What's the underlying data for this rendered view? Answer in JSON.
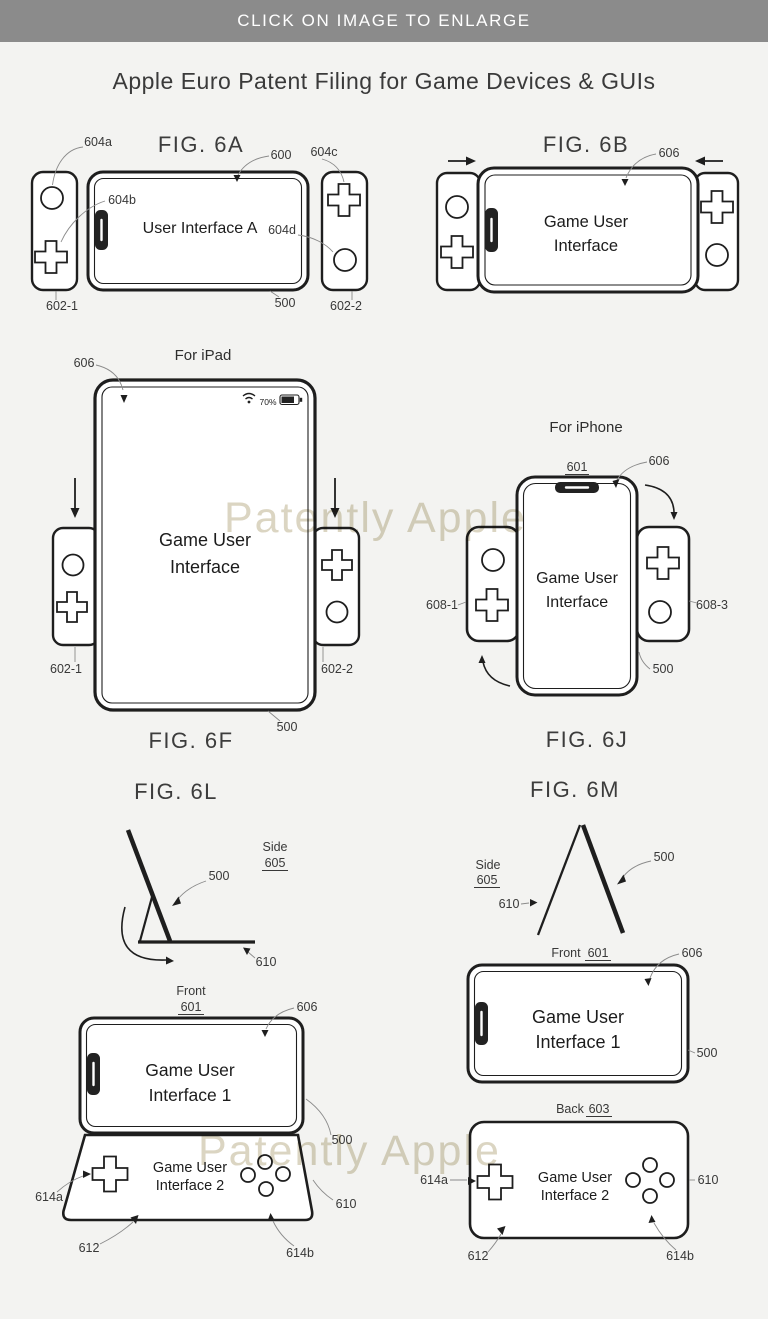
{
  "banner": {
    "text": "CLICK ON IMAGE TO ENLARGE"
  },
  "page_title": "Apple Euro Patent Filing for Game Devices & GUIs",
  "watermark": {
    "text": "Patently Apple"
  },
  "fig6a": {
    "title": "FIG. 6A",
    "screen_text": "User Interface A",
    "labels": {
      "n604a": "604a",
      "n604b": "604b",
      "n604c": "604c",
      "n604d": "604d",
      "n600": "600",
      "n500": "500",
      "n602_1": "602-1",
      "n602_2": "602-2"
    }
  },
  "fig6b": {
    "title": "FIG. 6B",
    "screen_line1": "Game User",
    "screen_line2": "Interface",
    "labels": {
      "n606": "606"
    }
  },
  "fig6f": {
    "title": "FIG. 6F",
    "subtitle": "For iPad",
    "screen_line1": "Game User",
    "screen_line2": "Interface",
    "status_battery": "70%",
    "labels": {
      "n606": "606",
      "n500": "500",
      "n602_1": "602-1",
      "n602_2": "602-2"
    }
  },
  "fig6j": {
    "title": "FIG. 6J",
    "subtitle": "For iPhone",
    "screen_line1": "Game User",
    "screen_line2": "Interface",
    "labels": {
      "n601": "601",
      "n606": "606",
      "n608_1": "608-1",
      "n608_3": "608-3",
      "n500": "500"
    }
  },
  "fig6l": {
    "title": "FIG. 6L",
    "side_label": "Side",
    "side_num": "605",
    "front_label": "Front",
    "front_num": "601",
    "screen1_line1": "Game User",
    "screen1_line2": "Interface 1",
    "screen2_line1": "Game User",
    "screen2_line2": "Interface 2",
    "labels": {
      "n500_side": "500",
      "n610_side": "610",
      "n606": "606",
      "n500": "500",
      "n614a": "614a",
      "n610": "610",
      "n612": "612",
      "n614b": "614b"
    }
  },
  "fig6m": {
    "title": "FIG. 6M",
    "side_label": "Side",
    "side_num": "605",
    "front_label": "Front",
    "front_num": "601",
    "back_label": "Back",
    "back_num": "603",
    "screen1_line1": "Game User",
    "screen1_line2": "Interface 1",
    "screen2_line1": "Game User",
    "screen2_line2": "Interface 2",
    "labels": {
      "n500_side": "500",
      "n610_side": "610",
      "n606": "606",
      "n500": "500",
      "n614a": "614a",
      "n610": "610",
      "n612": "612",
      "n614b": "614b"
    }
  }
}
